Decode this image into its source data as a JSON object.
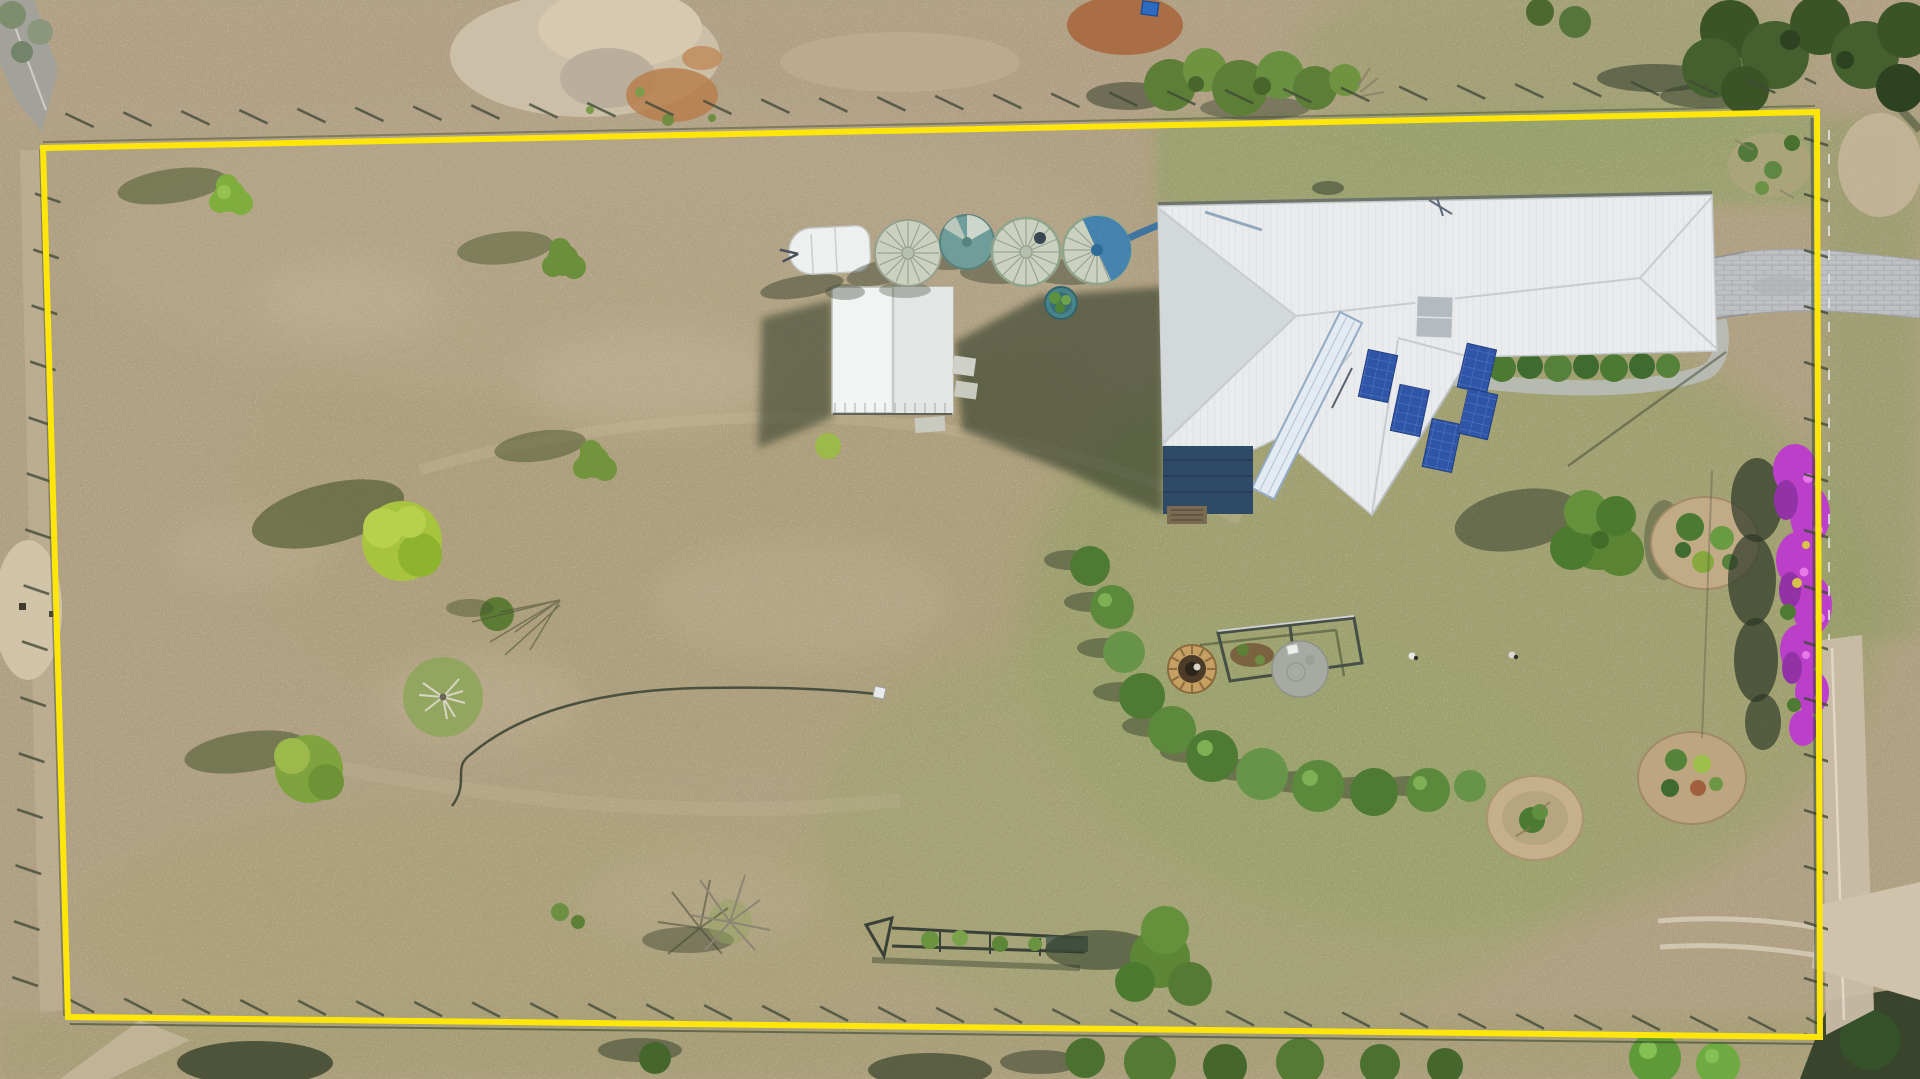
{
  "scene": {
    "type": "aerial-drone-photograph",
    "description": "Aerial drone photo of a rural acreage property marked with a yellow boundary overlay: white-roofed house with solar panels and skylights, garden shed, four round water tanks, a caravan, fire pit and play-frame garden, curved hedge row, purple bougainvillea along the east fence, scattered trees on a dry grass paddock, paver driveway exiting the north-east corner and a dirt track entering at the south-east.",
    "boundary": {
      "shape": "quadrilateral",
      "corners": [
        [
          43,
          148
        ],
        [
          1817,
          112
        ],
        [
          1820,
          1037
        ],
        [
          68,
          1017
        ]
      ]
    },
    "objects": [
      "property-boundary-overlay",
      "house-with-solar-panels",
      "clerestory-skylight",
      "roof-skylight",
      "veranda-deck",
      "garden-shed",
      "water-tanks (4)",
      "caravan",
      "potted-plant",
      "fire-pit",
      "play-frame",
      "concrete-pad",
      "hedge-row",
      "bougainvillea-hedge",
      "garden-beds (3)",
      "paver-driveway",
      "dirt-track",
      "garden-hose-with-sprinkler",
      "gate-and-cattle-race",
      "fence-lines",
      "trees-and-shrubs",
      "bare-winter-tree",
      "roadside-verge"
    ]
  },
  "colors": {
    "boundary": "#ffe60a",
    "fieldTan": "#b0a083",
    "grassOlive": "#9aa26c",
    "grassGreen": "#8ba35f",
    "roofWhite": "#e9ebec",
    "roofShade": "#d3d8db",
    "solarBlue": "#2f55a8",
    "deckBlue": "#2e4a66",
    "shedWhite": "#f2f4f3",
    "tankSage": "#cbd1bf",
    "tankBlue": "#3e7fae",
    "hedgeGreen": "#54803a",
    "bougainvillea": "#bb3fc9",
    "paver": "#bfc2c6",
    "dirtLight": "#cfc0a6",
    "shadow": "#2e3a28"
  }
}
